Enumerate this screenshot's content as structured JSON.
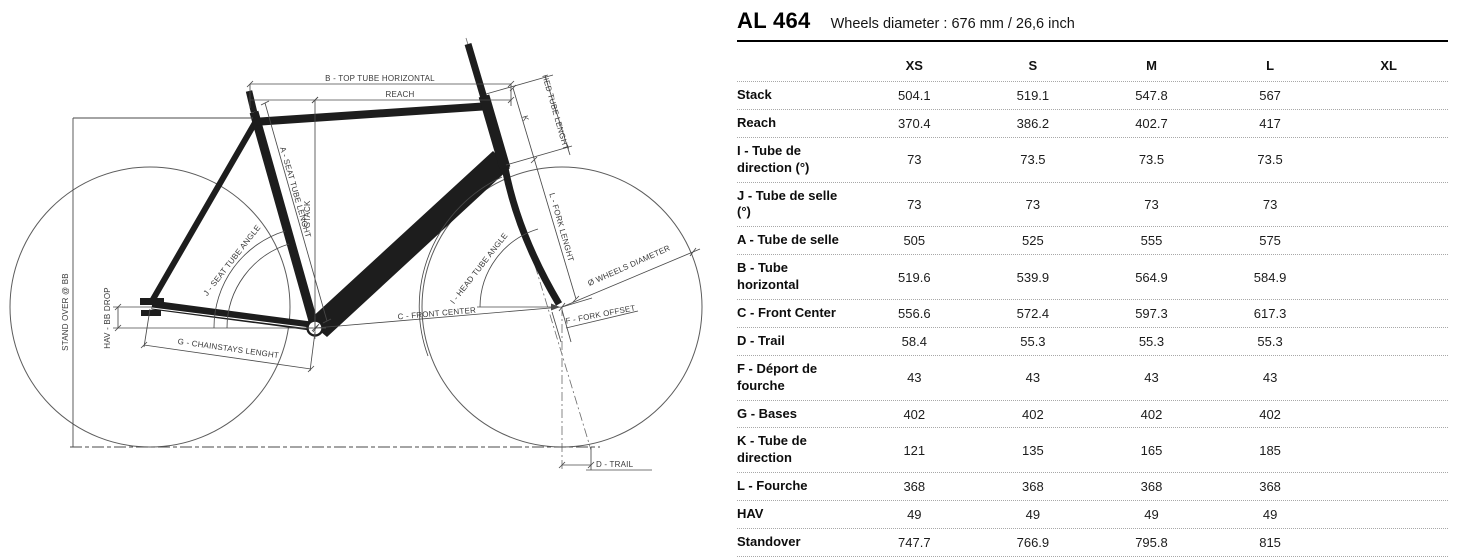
{
  "header": {
    "model": "AL 464",
    "subtitle": "Wheels diameter : 676 mm / 26,6 inch"
  },
  "table": {
    "size_headers": [
      "XS",
      "S",
      "M",
      "L",
      "XL"
    ],
    "rows": [
      {
        "label": "Stack",
        "values": [
          "504.1",
          "519.1",
          "547.8",
          "567",
          ""
        ]
      },
      {
        "label": "Reach",
        "values": [
          "370.4",
          "386.2",
          "402.7",
          "417",
          ""
        ]
      },
      {
        "label": "I - Tube de\ndirection (°)",
        "values": [
          "73",
          "73.5",
          "73.5",
          "73.5",
          ""
        ]
      },
      {
        "label": "J - Tube de selle (°)",
        "values": [
          "73",
          "73",
          "73",
          "73",
          ""
        ]
      },
      {
        "label": "A - Tube de selle",
        "values": [
          "505",
          "525",
          "555",
          "575",
          ""
        ]
      },
      {
        "label": "B - Tube horizontal",
        "values": [
          "519.6",
          "539.9",
          "564.9",
          "584.9",
          ""
        ]
      },
      {
        "label": "C - Front Center",
        "values": [
          "556.6",
          "572.4",
          "597.3",
          "617.3",
          ""
        ]
      },
      {
        "label": "D - Trail",
        "values": [
          "58.4",
          "55.3",
          "55.3",
          "55.3",
          ""
        ]
      },
      {
        "label": "F - Déport de\nfourche",
        "values": [
          "43",
          "43",
          "43",
          "43",
          ""
        ]
      },
      {
        "label": "G - Bases",
        "values": [
          "402",
          "402",
          "402",
          "402",
          ""
        ]
      },
      {
        "label": "K - Tube de\ndirection",
        "values": [
          "121",
          "135",
          "165",
          "185",
          ""
        ]
      },
      {
        "label": "L - Fourche",
        "values": [
          "368",
          "368",
          "368",
          "368",
          ""
        ]
      },
      {
        "label": "HAV",
        "values": [
          "49",
          "49",
          "49",
          "49",
          ""
        ]
      },
      {
        "label": "Standover",
        "values": [
          "747.7",
          "766.9",
          "795.8",
          "815",
          ""
        ]
      }
    ]
  },
  "diagram": {
    "labels": {
      "top_tube": "B - TOP TUBE HORIZONTAL",
      "reach": "REACH",
      "stack": "STACK",
      "seat_tube_length": "A - SEAT TUBE LENGHT",
      "head_tube_length": "HED TUBE LENGHT",
      "k": "K",
      "fork_length": "L - FORK LENGHT",
      "seat_tube_angle": "J - SEAT TUBE ANGLE",
      "head_tube_angle": "I - HEAD TUBE ANGLE",
      "wheels_diameter": "Ø WHEELS DIAMETER",
      "front_center": "C - FRONT CENTER",
      "fork_offset": "F - FORK OFFSET",
      "chainstays": "G - CHAINSTAYS LENGHT",
      "bb_drop": "HAV - BB DROP",
      "standover": "STAND OVER @ BB",
      "trail": "D - TRAIL"
    },
    "colors": {
      "frame": "#1d1d1d",
      "dimension_lines": "#4a4a4a",
      "label_text": "#3a3a3a"
    }
  }
}
